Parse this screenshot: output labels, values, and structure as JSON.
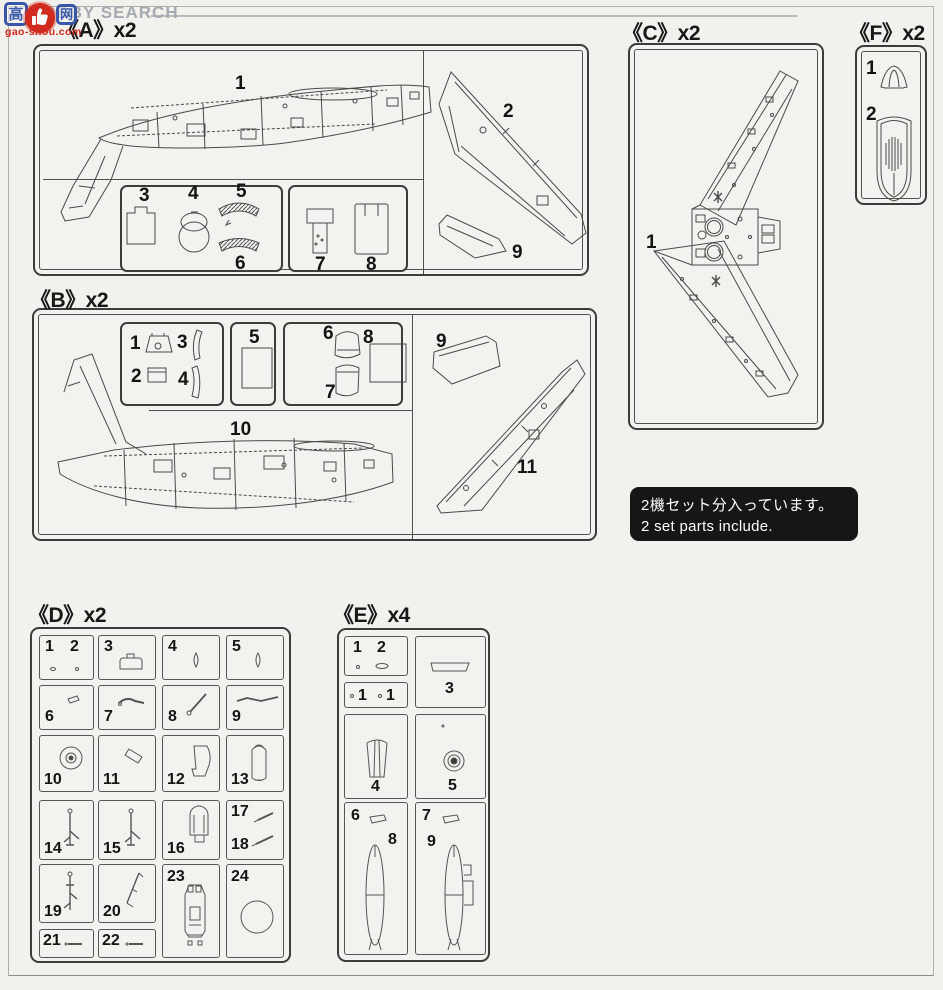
{
  "watermark": {
    "brand": "HOBBY SEARCH",
    "logo_char_left": "高",
    "logo_char_right": "网",
    "logo_domain": "gao-shou.com"
  },
  "note": {
    "jp": "2機セット分入っています。",
    "en": "2 set parts include."
  },
  "sprues": {
    "A": {
      "label": "《A》x2",
      "n1": "1",
      "n2": "2",
      "n3": "3",
      "n4": "4",
      "n5": "5",
      "n6": "6",
      "n7": "7",
      "n8": "8",
      "n9": "9"
    },
    "B": {
      "label": "《B》x2",
      "n1": "1",
      "n2": "2",
      "n3": "3",
      "n4": "4",
      "n5": "5",
      "n6": "6",
      "n7": "7",
      "n8": "8",
      "n9": "9",
      "n10": "10",
      "n11": "11"
    },
    "C": {
      "label": "《C》x2",
      "n1": "1"
    },
    "D": {
      "label": "《D》x2",
      "n1": "1",
      "n2": "2",
      "n3": "3",
      "n4": "4",
      "n5": "5",
      "n6": "6",
      "n7": "7",
      "n8": "8",
      "n9": "9",
      "n10": "10",
      "n11": "11",
      "n12": "12",
      "n13": "13",
      "n14": "14",
      "n15": "15",
      "n16": "16",
      "n17": "17",
      "n18": "18",
      "n19": "19",
      "n20": "20",
      "n21": "21",
      "n22": "22",
      "n23": "23",
      "n24": "24"
    },
    "E": {
      "label": "《E》x4",
      "n1": "1",
      "n1b": "1",
      "n1c": "1",
      "n2": "2",
      "n3": "3",
      "n4": "4",
      "n5": "5",
      "n6": "6",
      "n7": "7",
      "n8": "8",
      "n9": "9"
    },
    "F": {
      "label": "《F》x2",
      "n1": "1",
      "n2": "2"
    }
  }
}
